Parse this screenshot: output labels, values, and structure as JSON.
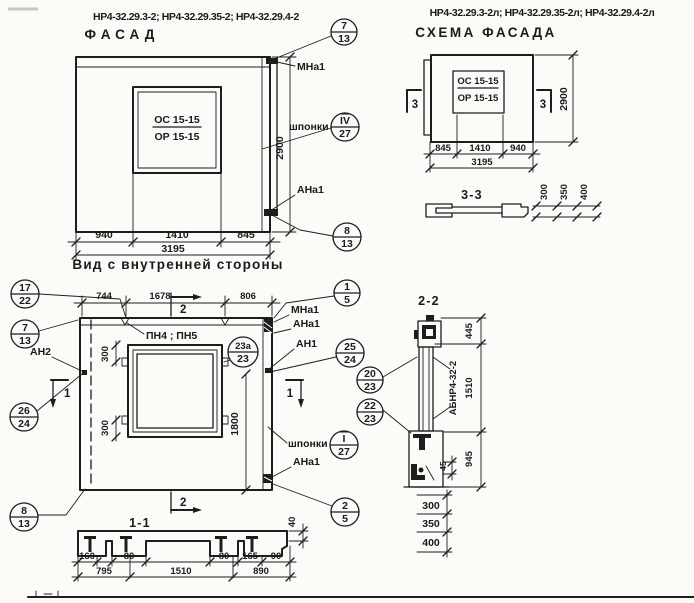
{
  "facade": {
    "code": "НР4-32.29.3-2; НР4-32.29.35-2; НР4-32.29.4-2",
    "title": "ФАСАД",
    "window_mark_top": "ОС 15-15",
    "window_mark_bottom": "ОР 15-15",
    "label_mna1": "МНа1",
    "label_shponki": "шпонки",
    "label_ana1": "АНа1",
    "dim_height": "2900",
    "dim_left": "940",
    "dim_mid": "1410",
    "dim_right": "845",
    "dim_total": "3195",
    "subtitle": "Вид с внутренней стороны",
    "callout_top": {
      "num": "7",
      "den": "13"
    },
    "callout_shponki": {
      "num": "IV",
      "den": "27"
    },
    "callout_bottom": {
      "num": "8",
      "den": "13"
    }
  },
  "scheme": {
    "code": "НР4-32.29.3-2л; НР4-32.29.35-2л; НР4-32.29.4-2л",
    "title": "СХЕМА ФАСАДА",
    "window_mark_top": "ОС 15-15",
    "window_mark_bottom": "ОР 15-15",
    "section_mark": "3",
    "dim_height": "2900",
    "dim_left": "845",
    "dim_mid": "1410",
    "dim_right": "940",
    "dim_total": "3195"
  },
  "section33": {
    "title": "3-3",
    "dim_1": "300",
    "dim_2": "350",
    "dim_3": "400"
  },
  "plan": {
    "dim_top_left": "744",
    "dim_top_mid": "1678",
    "dim_top_right": "806",
    "mark_pn": "ПН4 ; ПН5",
    "label_mna1": "МНа1",
    "label_ana1": "АНа1",
    "label_an1": "АН1",
    "label_an2": "АН2",
    "label_ana1_bottom": "АНа1",
    "label_shponki": "шпонки",
    "dim_win_top": "300",
    "dim_win_bottom": "300",
    "dim_height": "1800",
    "section_mark_1": "1",
    "section_mark_2": "2",
    "callout_17_22": {
      "num": "17",
      "den": "22"
    },
    "callout_7_13": {
      "num": "7",
      "den": "13"
    },
    "callout_1_5": {
      "num": "1",
      "den": "5"
    },
    "callout_23a_23": {
      "num": "23а",
      "den": "23"
    },
    "callout_25_24": {
      "num": "25",
      "den": "24"
    },
    "callout_26_24": {
      "num": "26",
      "den": "24"
    },
    "callout_i_27": {
      "num": "I",
      "den": "27"
    },
    "callout_8_13": {
      "num": "8",
      "den": "13"
    },
    "callout_2_5": {
      "num": "2",
      "den": "5"
    }
  },
  "section11": {
    "title": "1-1",
    "section_mark": "2",
    "dims_row1": [
      "160",
      "80",
      "80",
      "165",
      "90"
    ],
    "dims_row2": [
      "795",
      "1510",
      "890"
    ],
    "dim_40": "40"
  },
  "section22": {
    "title": "2-2",
    "label_abnr": "АБНР4-32-2",
    "dim_445": "445",
    "dim_1510": "1510",
    "dim_945": "945",
    "dim_45": "45",
    "dim_b1": "300",
    "dim_b2": "350",
    "dim_b3": "400",
    "callout_20_23": {
      "num": "20",
      "den": "23"
    },
    "callout_22_23": {
      "num": "22",
      "den": "23"
    }
  }
}
